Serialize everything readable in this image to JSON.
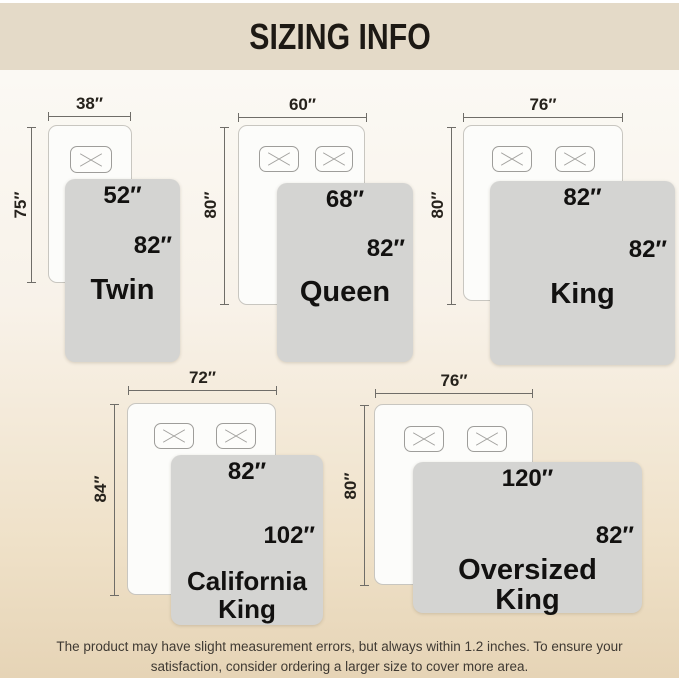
{
  "title": "SIZING INFO",
  "colors": {
    "header_bg": "#e4dac8",
    "blanket": "#d4d4d2",
    "background_bottom": "#e6d4b6"
  },
  "sizes": [
    {
      "name_line1": "Twin",
      "name_line2": "",
      "bed_width": "38″",
      "bed_length": "75″",
      "blanket_width": "52″",
      "blanket_length": "82″",
      "pillow_count": 1
    },
    {
      "name_line1": "Queen",
      "name_line2": "",
      "bed_width": "60″",
      "bed_length": "80″",
      "blanket_width": "68″",
      "blanket_length": "82″",
      "pillow_count": 2
    },
    {
      "name_line1": "King",
      "name_line2": "",
      "bed_width": "76″",
      "bed_length": "80″",
      "blanket_width": "82″",
      "blanket_length": "82″",
      "pillow_count": 2
    },
    {
      "name_line1": "California",
      "name_line2": "King",
      "bed_width": "72″",
      "bed_length": "84″",
      "blanket_width": "82″",
      "blanket_length": "102″",
      "pillow_count": 2
    },
    {
      "name_line1": "Oversized",
      "name_line2": "King",
      "bed_width": "76″",
      "bed_length": "80″",
      "blanket_width": "120″",
      "blanket_length": "82″",
      "pillow_count": 2
    }
  ],
  "footer": {
    "line1": "The product may have slight measurement errors, but always within 1.2 inches. To ensure your",
    "line2": "satisfaction, consider ordering a larger size to cover more area."
  }
}
